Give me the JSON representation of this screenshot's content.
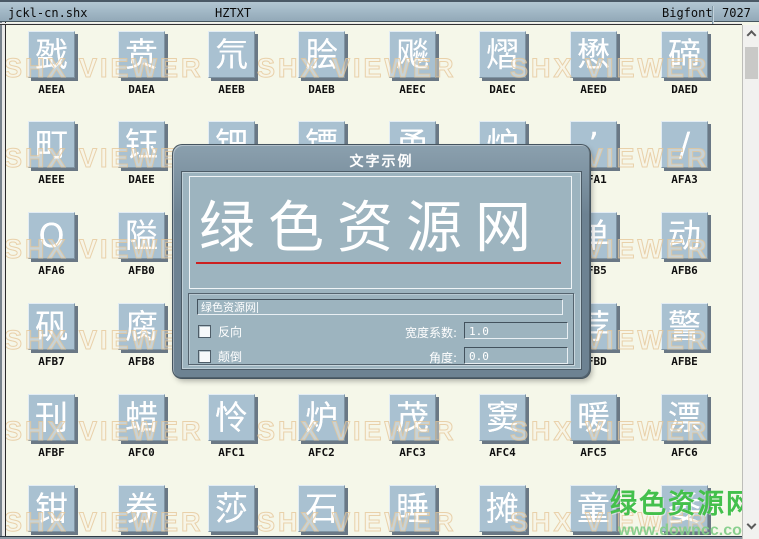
{
  "titlebar": {
    "filename": "jckl-cn.shx",
    "font_name": "HZTXT",
    "font_type": "Bigfont",
    "glyph_count": "7027"
  },
  "watermark": {
    "text": "SHX VIEWER"
  },
  "grid": {
    "tiles": [
      {
        "row": 0,
        "col": 0,
        "char": "戤",
        "label": "AEEA"
      },
      {
        "row": 0,
        "col": 1,
        "char": "贲",
        "label": "DAEA"
      },
      {
        "row": 0,
        "col": 2,
        "char": "氘",
        "label": "AEEB"
      },
      {
        "row": 0,
        "col": 3,
        "char": "脍",
        "label": "DAEB"
      },
      {
        "row": 0,
        "col": 4,
        "char": "飚",
        "label": "AEEC"
      },
      {
        "row": 0,
        "col": 5,
        "char": "熠",
        "label": "DAEC"
      },
      {
        "row": 0,
        "col": 6,
        "char": "懋",
        "label": "AEED"
      },
      {
        "row": 0,
        "col": 7,
        "char": "碲",
        "label": "DAED"
      },
      {
        "row": 1,
        "col": 0,
        "char": "町",
        "label": "AEEE"
      },
      {
        "row": 1,
        "col": 1,
        "char": "钰",
        "label": "DAEE"
      },
      {
        "row": 1,
        "col": 2,
        "char": "钿",
        "label": ""
      },
      {
        "row": 1,
        "col": 3,
        "char": "镖",
        "label": ""
      },
      {
        "row": 1,
        "col": 4,
        "char": "甬",
        "label": ""
      },
      {
        "row": 1,
        "col": 5,
        "char": "炉",
        "label": ""
      },
      {
        "row": 1,
        "col": 6,
        "char": "’",
        "label": "AFA1"
      },
      {
        "row": 1,
        "col": 7,
        "char": "/",
        "label": "AFA3"
      },
      {
        "row": 2,
        "col": 0,
        "char": "O",
        "label": "AFA6"
      },
      {
        "row": 2,
        "col": 1,
        "char": "隘",
        "label": "AFB0"
      },
      {
        "row": 2,
        "col": 6,
        "char": "单",
        "label": "AFB5"
      },
      {
        "row": 2,
        "col": 7,
        "char": "动",
        "label": "AFB6"
      },
      {
        "row": 3,
        "col": 0,
        "char": "矾",
        "label": "AFB7"
      },
      {
        "row": 3,
        "col": 1,
        "char": "腐",
        "label": "AFB8"
      },
      {
        "row": 3,
        "col": 6,
        "char": "荐",
        "label": "AFBD"
      },
      {
        "row": 3,
        "col": 7,
        "char": "警",
        "label": "AFBE"
      },
      {
        "row": 4,
        "col": 0,
        "char": "刊",
        "label": "AFBF"
      },
      {
        "row": 4,
        "col": 1,
        "char": "蜡",
        "label": "AFC0"
      },
      {
        "row": 4,
        "col": 2,
        "char": "怜",
        "label": "AFC1"
      },
      {
        "row": 4,
        "col": 3,
        "char": "炉",
        "label": "AFC2"
      },
      {
        "row": 4,
        "col": 4,
        "char": "茂",
        "label": "AFC3"
      },
      {
        "row": 4,
        "col": 5,
        "char": "窦",
        "label": "AFC4"
      },
      {
        "row": 4,
        "col": 6,
        "char": "暖",
        "label": "AFC5"
      },
      {
        "row": 4,
        "col": 7,
        "char": "漂",
        "label": "AFC6"
      },
      {
        "row": 5,
        "col": 0,
        "char": "钳",
        "label": ""
      },
      {
        "row": 5,
        "col": 1,
        "char": "券",
        "label": ""
      },
      {
        "row": 5,
        "col": 2,
        "char": "莎",
        "label": ""
      },
      {
        "row": 5,
        "col": 3,
        "char": "石",
        "label": ""
      },
      {
        "row": 5,
        "col": 4,
        "char": "睡",
        "label": ""
      },
      {
        "row": 5,
        "col": 5,
        "char": "摊",
        "label": ""
      },
      {
        "row": 5,
        "col": 6,
        "char": "童",
        "label": ""
      },
      {
        "row": 5,
        "col": 7,
        "char": "委",
        "label": ""
      }
    ]
  },
  "dialog": {
    "title": "文字示例",
    "preview_text": "绿色资源网",
    "input_value": "绿色资源网",
    "reverse_label": "反向",
    "flip_label": "颠倒",
    "width_factor_label": "宽度系数:",
    "width_factor_value": "1.0",
    "angle_label": "角度:",
    "angle_value": "0.0"
  },
  "site_watermark": {
    "line1": "绿色资源网",
    "line2": "www.downcc.com"
  },
  "colors": {
    "titlebar-bg": "#a3b9c7",
    "content-bg": "#f5f7e9",
    "tile-bg": "#a9c1d1",
    "tile-shadow": "#6a7885",
    "dialog-frame": "#6d8292",
    "dialog-panel": "#9db4bf",
    "underline-red": "#cc2020",
    "watermark-tan": "#ecd9b8",
    "site-green": "#44c04c",
    "scrollbar-track": "#f1f1ef",
    "scrollbar-thumb": "#c9c9c7"
  }
}
